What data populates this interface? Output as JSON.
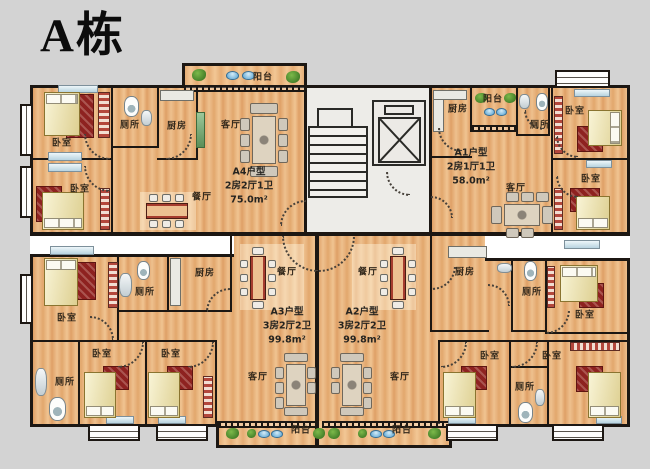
{
  "title": "A栋",
  "units": [
    {
      "id": "A4",
      "name": "A4户型",
      "layout": "2房2厅1卫",
      "area": "75.0m²"
    },
    {
      "id": "A1",
      "name": "A1户型",
      "layout": "2房1厅1卫",
      "area": "58.0m²"
    },
    {
      "id": "A3",
      "name": "A3户型",
      "layout": "3房2厅2卫",
      "area": "99.8m²"
    },
    {
      "id": "A2",
      "name": "A2户型",
      "layout": "3房2厅2卫",
      "area": "99.8m²"
    }
  ],
  "room_labels": [
    {
      "room": "balcony",
      "text": "阳台",
      "x": 263,
      "y": 78
    },
    {
      "room": "bedroom",
      "text": "卧室",
      "x": 62,
      "y": 144
    },
    {
      "room": "toilet",
      "text": "厕所",
      "x": 130,
      "y": 126
    },
    {
      "room": "kitchen",
      "text": "厨房",
      "x": 177,
      "y": 127
    },
    {
      "room": "living",
      "text": "客厅",
      "x": 231,
      "y": 126
    },
    {
      "room": "bedroom",
      "text": "卧室",
      "x": 80,
      "y": 190
    },
    {
      "room": "dining",
      "text": "餐厅",
      "x": 202,
      "y": 198
    },
    {
      "room": "kitchen",
      "text": "厨房",
      "x": 458,
      "y": 110
    },
    {
      "room": "balcony",
      "text": "阳台",
      "x": 493,
      "y": 100
    },
    {
      "room": "toilet",
      "text": "厕所",
      "x": 540,
      "y": 126
    },
    {
      "room": "bedroom",
      "text": "卧室",
      "x": 575,
      "y": 112
    },
    {
      "room": "bedroom",
      "text": "卧室",
      "x": 591,
      "y": 180
    },
    {
      "room": "living",
      "text": "客厅",
      "x": 516,
      "y": 189
    },
    {
      "room": "bedroom",
      "text": "卧室",
      "x": 67,
      "y": 319
    },
    {
      "room": "toilet",
      "text": "厕所",
      "x": 145,
      "y": 293
    },
    {
      "room": "kitchen",
      "text": "厨房",
      "x": 205,
      "y": 274
    },
    {
      "room": "dining",
      "text": "餐厅",
      "x": 287,
      "y": 273
    },
    {
      "room": "toilet",
      "text": "厕所",
      "x": 65,
      "y": 383
    },
    {
      "room": "bedroom",
      "text": "卧室",
      "x": 102,
      "y": 355
    },
    {
      "room": "bedroom",
      "text": "卧室",
      "x": 171,
      "y": 355
    },
    {
      "room": "living",
      "text": "客厅",
      "x": 258,
      "y": 378
    },
    {
      "room": "balcony",
      "text": "阳台",
      "x": 301,
      "y": 431
    },
    {
      "room": "dining",
      "text": "餐厅",
      "x": 368,
      "y": 273
    },
    {
      "room": "kitchen",
      "text": "厨房",
      "x": 465,
      "y": 273
    },
    {
      "room": "toilet",
      "text": "厕所",
      "x": 532,
      "y": 293
    },
    {
      "room": "bedroom",
      "text": "卧室",
      "x": 585,
      "y": 316
    },
    {
      "room": "bedroom",
      "text": "卧室",
      "x": 490,
      "y": 357
    },
    {
      "room": "toilet",
      "text": "厕所",
      "x": 525,
      "y": 388
    },
    {
      "room": "bedroom",
      "text": "卧室",
      "x": 552,
      "y": 357
    },
    {
      "room": "living",
      "text": "客厅",
      "x": 400,
      "y": 378
    },
    {
      "room": "balcony",
      "text": "阳台",
      "x": 402,
      "y": 431
    }
  ],
  "colors": {
    "background": "#d3d3d3",
    "wall": "#1c1713",
    "corridor": "#ffffff",
    "floor": "#e8b078",
    "carpet": "#8e2220",
    "bed": "#f2e9ad",
    "core": "#edece8",
    "plant": "#3f7d26",
    "window": "#bfd9e4"
  }
}
